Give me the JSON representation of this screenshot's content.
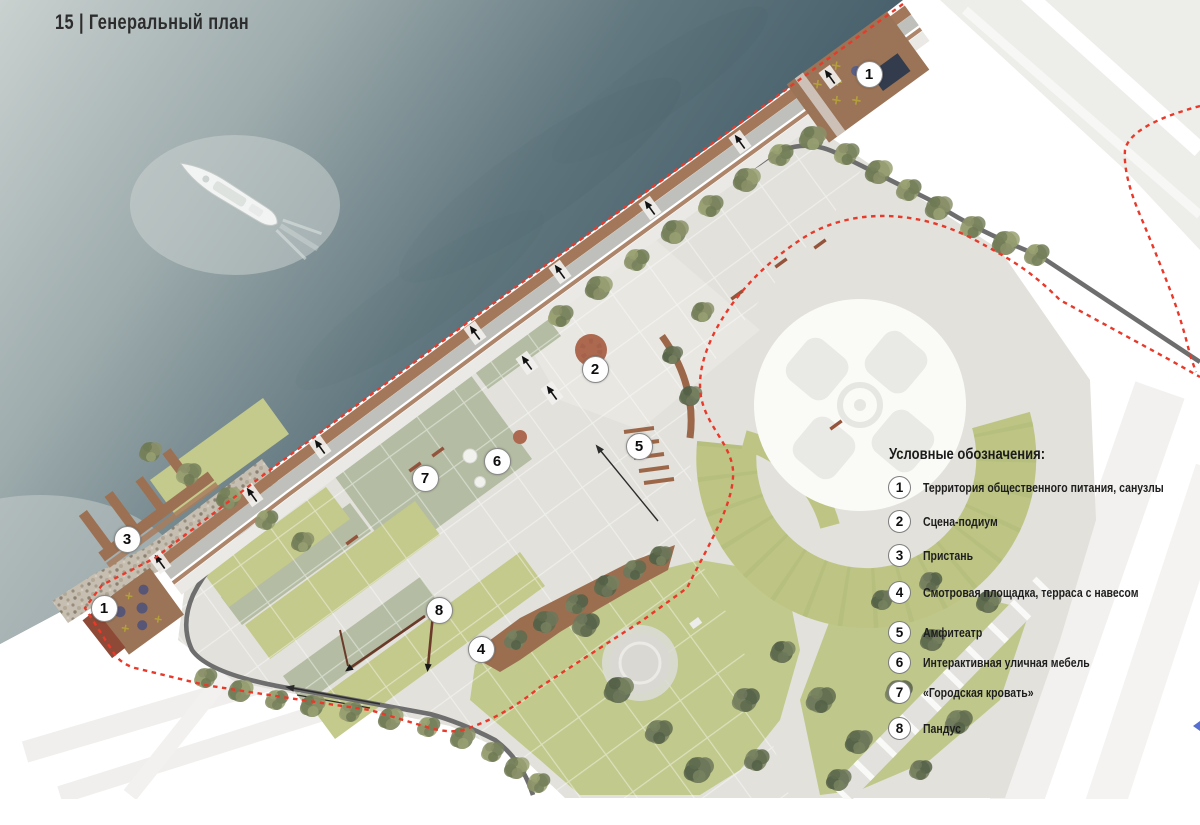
{
  "page": {
    "title": "15 | Генеральный план"
  },
  "legend": {
    "title": "Условные обозначения:",
    "items": [
      {
        "num": "1",
        "label": "Территория общественного питания, санузлы"
      },
      {
        "num": "2",
        "label": "Сцена-подиум"
      },
      {
        "num": "3",
        "label": "Пристань"
      },
      {
        "num": "4",
        "label": "Смотровая площадка, терраса с навесом"
      },
      {
        "num": "5",
        "label": "Амфитеатр"
      },
      {
        "num": "6",
        "label": "Интерактивная уличная мебель"
      },
      {
        "num": "7",
        "label": "«Городская кровать»"
      },
      {
        "num": "8",
        "label": "Пандус"
      }
    ]
  },
  "plan": {
    "markers": [
      {
        "num": "1",
        "x": 868,
        "y": 73
      },
      {
        "num": "2",
        "x": 594,
        "y": 368
      },
      {
        "num": "3",
        "x": 126,
        "y": 538
      },
      {
        "num": "1",
        "x": 103,
        "y": 607
      },
      {
        "num": "4",
        "x": 480,
        "y": 648
      },
      {
        "num": "5",
        "x": 638,
        "y": 445
      },
      {
        "num": "6",
        "x": 496,
        "y": 460
      },
      {
        "num": "7",
        "x": 424,
        "y": 477
      },
      {
        "num": "8",
        "x": 438,
        "y": 609
      }
    ]
  },
  "colors": {
    "boundary_red": "#e8392a",
    "water": "#47606b",
    "lawn": "#c4c98c",
    "sage": "#b4bca3",
    "wood_deck": "#9d7355",
    "terracotta": "#8e4a37",
    "road": "#6e6e6e"
  }
}
